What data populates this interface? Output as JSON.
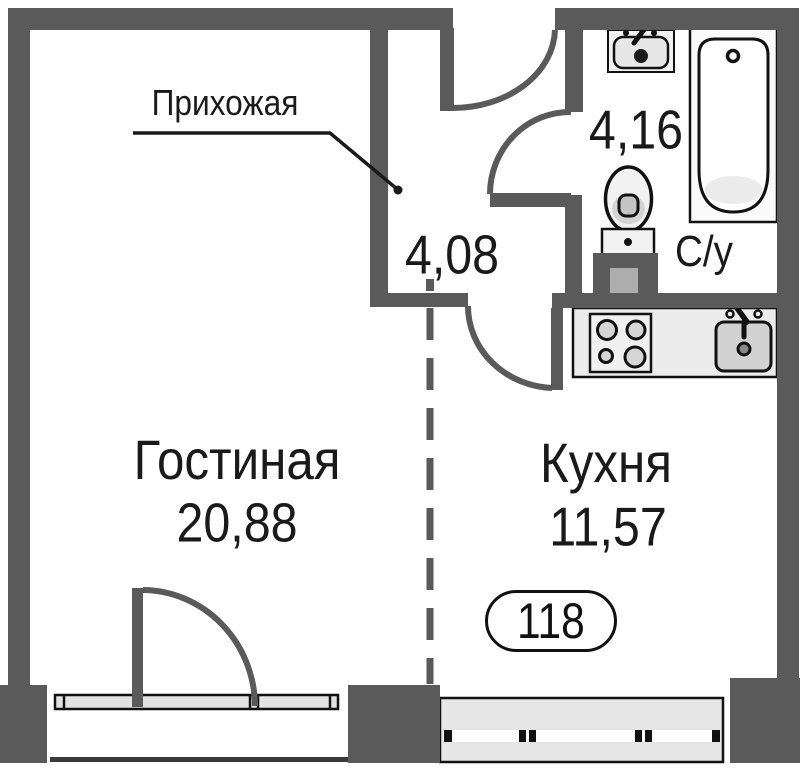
{
  "plan_title": "apartment floor plan",
  "apartment_number": "118",
  "rooms": [
    {
      "key": "hallway",
      "label": "Прихожая",
      "area": "4,08"
    },
    {
      "key": "bathroom",
      "label": "С/у",
      "area": "4,16"
    },
    {
      "key": "living_room",
      "label": "Гостиная",
      "area": "20,88"
    },
    {
      "key": "kitchen",
      "label": "Кухня",
      "area": "11,57"
    }
  ],
  "fixtures": [
    "washbasin",
    "bathtub",
    "toilet",
    "vent-shaft",
    "stove",
    "kitchen-sink",
    "kitchen-counter"
  ],
  "colors": {
    "wall": "#5a5a5a",
    "outline": "#111111",
    "text": "#1a1a1a",
    "window_fill": "#e4e4e4",
    "counter_fill": "#ececec",
    "fixture_fill": "#f2f2f2"
  }
}
